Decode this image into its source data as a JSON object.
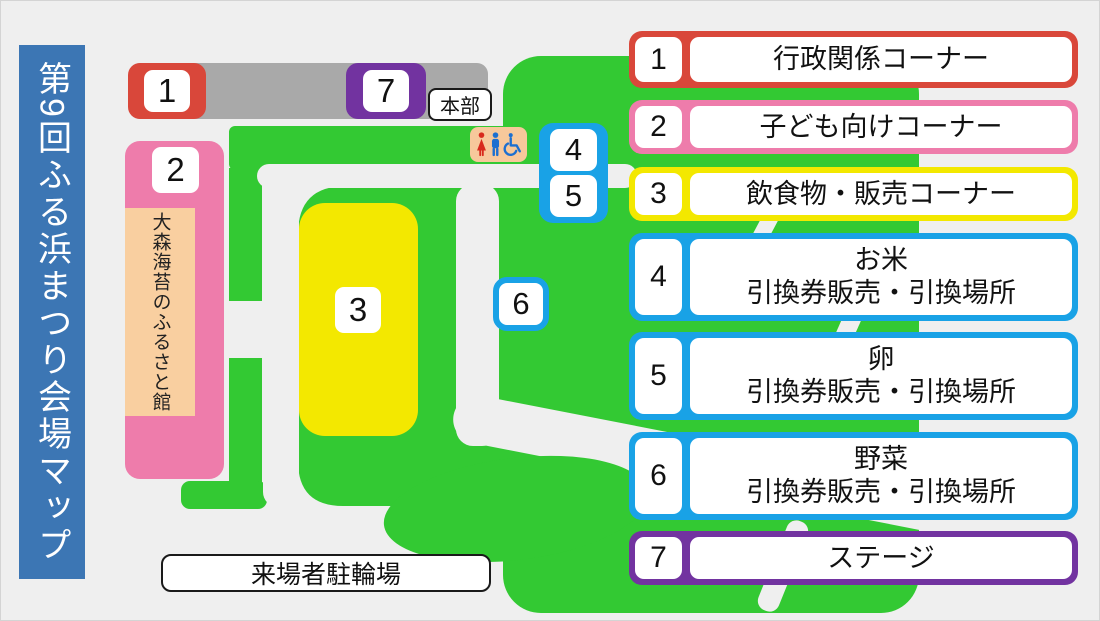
{
  "title": "第9回ふる浜まつり会場マップ",
  "map": {
    "markers": {
      "m1": "1",
      "m2": "2",
      "m3": "3",
      "m4": "4",
      "m5": "5",
      "m6": "6",
      "m7": "7"
    },
    "headquarters_label": "本部",
    "museum_label": "大森海苔のふるさと館",
    "bicycle_parking_label": "来場者駐輪場",
    "toilet_icons": [
      "female-icon",
      "male-icon",
      "wheelchair-icon"
    ]
  },
  "legend": {
    "items": [
      {
        "number": "1",
        "line1": "行政関係コーナー",
        "line2": "",
        "color": "#d9473a"
      },
      {
        "number": "2",
        "line1": "子ども向けコーナー",
        "line2": "",
        "color": "#ee7cab"
      },
      {
        "number": "3",
        "line1": "飲食物・販売コーナー",
        "line2": "",
        "color": "#f3e800"
      },
      {
        "number": "4",
        "line1": "お米",
        "line2": "引換券販売・引換場所",
        "color": "#19a2e6"
      },
      {
        "number": "5",
        "line1": "卵",
        "line2": "引換券販売・引換場所",
        "color": "#19a2e6"
      },
      {
        "number": "6",
        "line1": "野菜",
        "line2": "引換券販売・引換場所",
        "color": "#19a2e6"
      },
      {
        "number": "7",
        "line1": "ステージ",
        "line2": "",
        "color": "#7233a0"
      }
    ]
  },
  "colors": {
    "background": "#efefef",
    "banner_blue": "#3c76b4",
    "grass_green": "#33c933",
    "path_white": "#efefef",
    "stage_gray": "#a9a9a9",
    "area_pink": "#ee7cab",
    "area_yellow": "#f3e800",
    "marker_red": "#d9473a",
    "marker_purple": "#7233a0",
    "marker_blue": "#19a2e6",
    "toilet_peach": "#f7c89b",
    "museum_peach": "#f9cfa0",
    "toilet_female_red": "#d8291c",
    "toilet_male_blue": "#1d6fd0"
  }
}
